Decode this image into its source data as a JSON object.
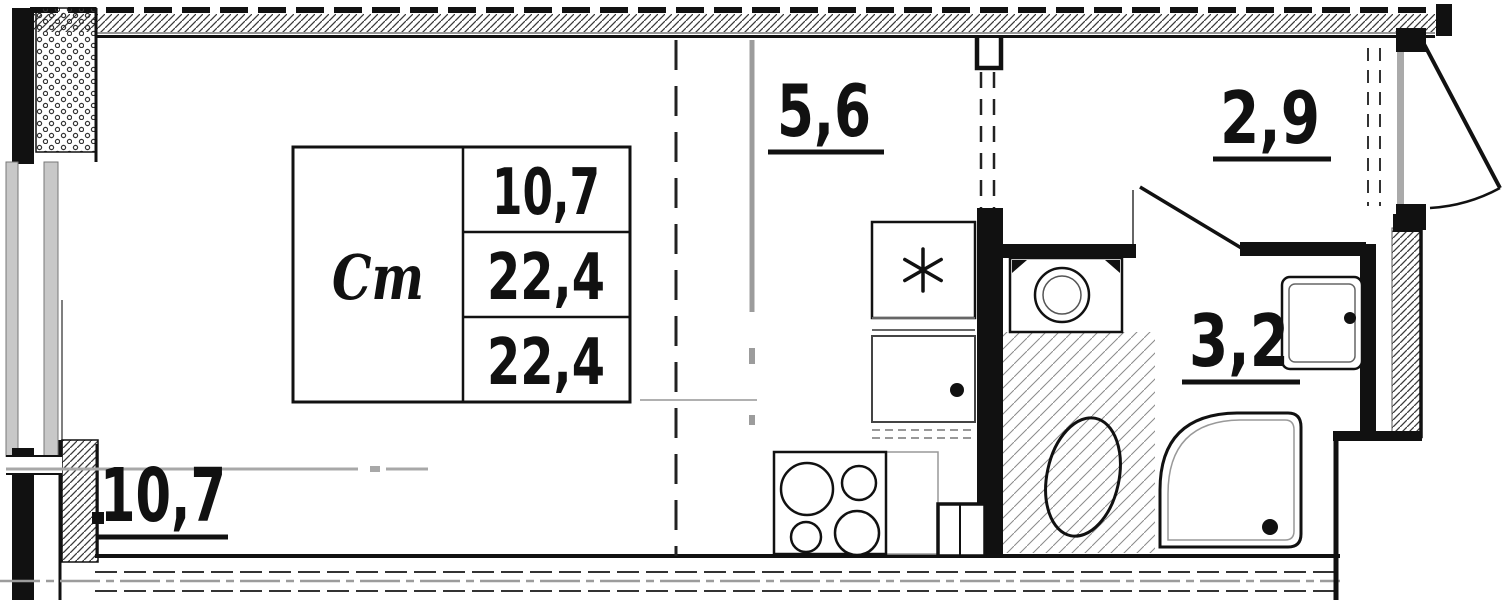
{
  "colors": {
    "line": "#111111",
    "axis": "#9c9c9c",
    "glazing": "#c8c8c8"
  },
  "plan": {
    "unit_type_label": "Ст",
    "area_table": {
      "living_area": "10,7",
      "total_area": "22,4",
      "reduced_total_area": "22,4"
    },
    "rooms": {
      "living_area": "10,7",
      "kitchen_area": "5,6",
      "hall_area": "2,9",
      "bathroom_area": "3,2"
    }
  }
}
